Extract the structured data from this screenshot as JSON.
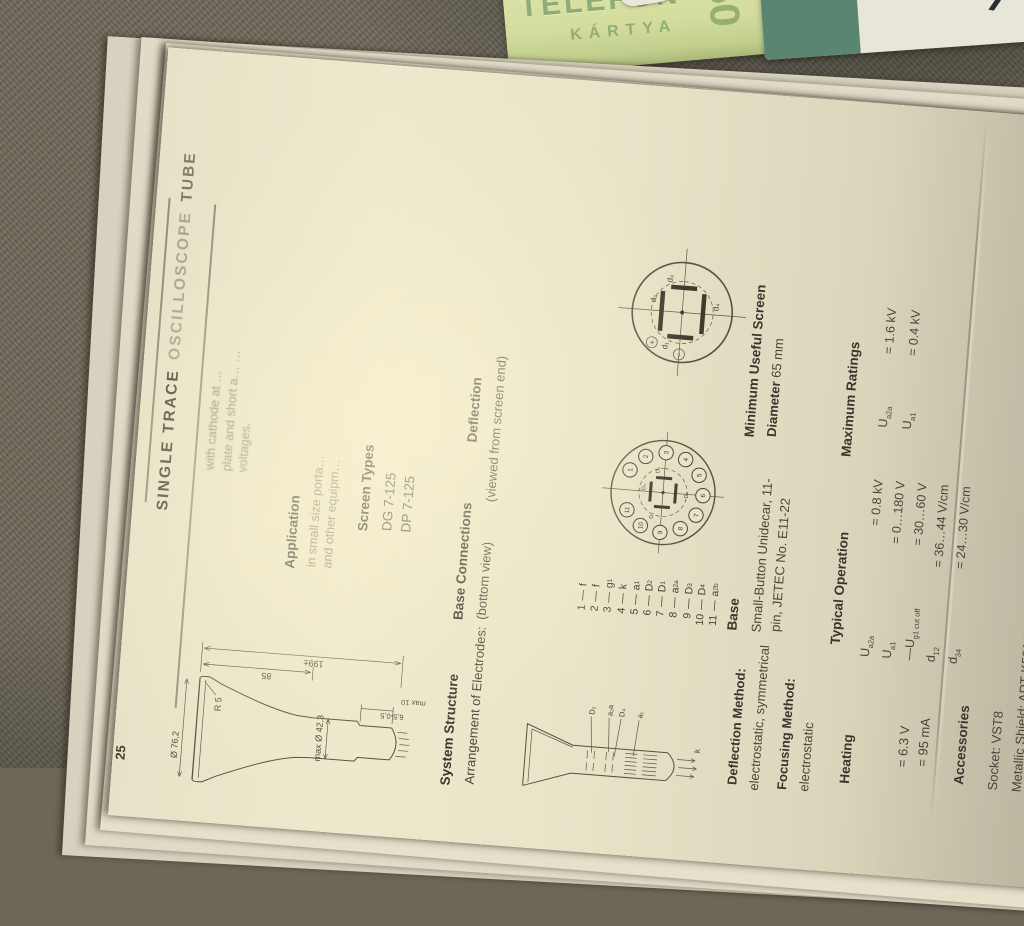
{
  "scene": {
    "phone_card": {
      "title_line1": "TELEFON",
      "title_line2": "KÁRTYA",
      "big_number": "50",
      "sticker_text": "5B",
      "band_text": "Früch\nGlück"
    },
    "right_card": {
      "mark": "7"
    }
  },
  "page": {
    "page_number": "25",
    "title": {
      "p1": "SINGLE TRACE",
      "p2": "OSCILLOSCOPE",
      "p3": "TUBE"
    },
    "intro": {
      "l1": "with cathode at …",
      "l2": "plate and short a… …",
      "l3": "voltages."
    },
    "application": {
      "heading": "Application",
      "l1": "in small size porta…",
      "l2": "and other equipm…"
    },
    "screen_types": {
      "heading": "Screen Types",
      "types": [
        "DG 7-125",
        "DP 7-125"
      ]
    },
    "base_connections": {
      "heading": "Base Connections",
      "subheading": "(bottom view)",
      "separator": "—",
      "pins": [
        {
          "num": "1",
          "label": "f",
          "sub": ""
        },
        {
          "num": "2",
          "label": "f",
          "sub": ""
        },
        {
          "num": "3",
          "label": "g",
          "sub": "1"
        },
        {
          "num": "4",
          "label": "k",
          "sub": ""
        },
        {
          "num": "5",
          "label": "a",
          "sub": "1"
        },
        {
          "num": "6",
          "label": "D",
          "sub": "2"
        },
        {
          "num": "7",
          "label": "D",
          "sub": "1"
        },
        {
          "num": "8",
          "label": "a",
          "sub": "2a"
        },
        {
          "num": "9",
          "label": "D",
          "sub": "3"
        },
        {
          "num": "10",
          "label": "D",
          "sub": "4"
        },
        {
          "num": "11",
          "label": "a",
          "sub": "2b"
        }
      ],
      "diagram_labels": {
        "top": "D₂",
        "left": "D₁",
        "right": "D₃",
        "bottom": "D₄"
      }
    },
    "deflection": {
      "heading": "Deflection",
      "subheading": "(viewed from screen end)",
      "plate_labels": {
        "top": "d₂",
        "left": "d₁",
        "right": "d₃",
        "bottom": "d₄"
      },
      "polarity_plus": "+",
      "polarity_minus": "−"
    },
    "base": {
      "heading": "Base",
      "l1": "Small-Button Unidecar, 11-",
      "l2": "pin, JETEC No. E11-22"
    },
    "min_screen": {
      "heading": "Minimum Useful Screen",
      "label": "Diameter",
      "value": "65 mm"
    },
    "max_ratings": {
      "heading": "Maximum Ratings",
      "rows": [
        {
          "sym": "U",
          "sub": "a2a",
          "val": "= 1.6 kV"
        },
        {
          "sym": "U",
          "sub": "a1",
          "val": "= 0.4 kV"
        }
      ]
    },
    "typical_operation": {
      "heading": "Typical Operation",
      "rows": [
        {
          "sym": "U",
          "sub": "a2a",
          "val": "=  0.8 kV"
        },
        {
          "sym": "U",
          "sub": "a1",
          "val": "= 0…180 V"
        },
        {
          "sym": "—U",
          "sub": "g1 cut off",
          "val": "= 30…60 V"
        },
        {
          "sym": "d",
          "sub": "12",
          "val": "= 36…44 V/cm"
        },
        {
          "sym": "d",
          "sub": "34",
          "val": "= 24…30 V/cm"
        }
      ]
    },
    "dimensions": {
      "total_length": "199±",
      "front_length": "85",
      "face_dia": "Ø 76,2",
      "rim_radius": "R 5",
      "neck_dia": "max Ø 42,3",
      "base_dim": "6,5-0,5",
      "base_dim2": "max 10"
    },
    "system_structure": {
      "heading": "System Structure",
      "subheading": "Arrangement of Electrodes:",
      "label1": "D₂",
      "label2": "a₂a",
      "label3": "D₄",
      "label4": "a₁",
      "cathode": "k"
    },
    "methods": {
      "l1": "Deflection Method:",
      "l2": "electrostatic, symmetrical",
      "l3": "Focusing Method:",
      "l4": "electrostatic"
    },
    "heating": {
      "heading": "Heating",
      "v1": "= 6.3 V",
      "v2": "= 95 mA"
    },
    "accessories": {
      "heading": "Accessories",
      "l1": "Socket: VST8",
      "l2": "Metallic Shield: ART-K591A"
    }
  }
}
